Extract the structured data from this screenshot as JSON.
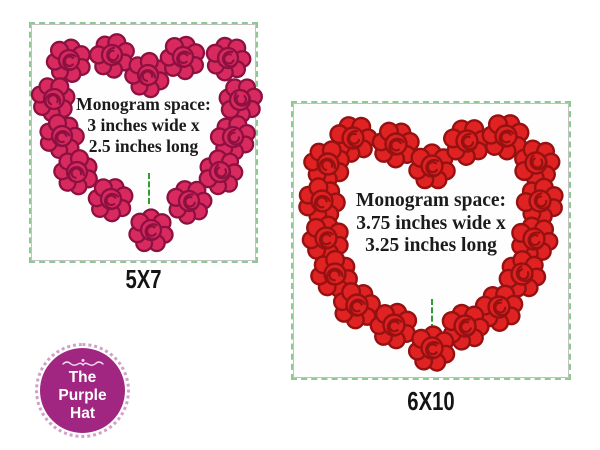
{
  "panels": [
    {
      "name": "5x7",
      "label": "5X7",
      "monogram": {
        "line1": "Monogram space:",
        "line2": "3 inches wide x",
        "line3": "2.5 inches long"
      },
      "rose_color": "#d92a60",
      "rose_outline": "#8c1040",
      "rose_size": 42,
      "border_stitch_color": "#8fc890",
      "placement_line_color": "#2f9e2f",
      "roses": [
        [
          38,
          36,
          10
        ],
        [
          81,
          31,
          -35
        ],
        [
          117,
          51,
          60
        ],
        [
          152,
          33,
          15
        ],
        [
          197,
          34,
          -15
        ],
        [
          23,
          75,
          80
        ],
        [
          209,
          76,
          -80
        ],
        [
          31,
          112,
          35
        ],
        [
          202,
          113,
          -35
        ],
        [
          46,
          148,
          65
        ],
        [
          189,
          148,
          -65
        ],
        [
          80,
          175,
          20
        ],
        [
          158,
          177,
          -20
        ],
        [
          120,
          206,
          0
        ]
      ]
    },
    {
      "name": "6x10",
      "label": "6X10",
      "monogram": {
        "line1": "Monogram space:",
        "line2": "3.75 inches wide x",
        "line3": "3.25 inches long"
      },
      "rose_color": "#e12222",
      "rose_outline": "#961111",
      "rose_size": 44,
      "border_stitch_color": "#8fc890",
      "placement_line_color": "#2f9e2f",
      "roses": [
        [
          60,
          35,
          -20
        ],
        [
          103,
          41,
          25
        ],
        [
          139,
          63,
          0
        ],
        [
          174,
          38,
          -25
        ],
        [
          213,
          33,
          20
        ],
        [
          35,
          61,
          70
        ],
        [
          243,
          60,
          -70
        ],
        [
          29,
          98,
          40
        ],
        [
          247,
          98,
          -40
        ],
        [
          33,
          135,
          10
        ],
        [
          241,
          136,
          -10
        ],
        [
          42,
          171,
          55
        ],
        [
          229,
          171,
          -55
        ],
        [
          64,
          202,
          30
        ],
        [
          206,
          204,
          -30
        ],
        [
          101,
          222,
          15
        ],
        [
          172,
          223,
          -15
        ],
        [
          139,
          245,
          5
        ]
      ]
    }
  ],
  "logo": {
    "line1": "The",
    "line2": "Purple",
    "line3": "Hat",
    "bg_color": "#a12682",
    "ring_color": "#cfa0c8",
    "text_color": "#ffffff"
  }
}
